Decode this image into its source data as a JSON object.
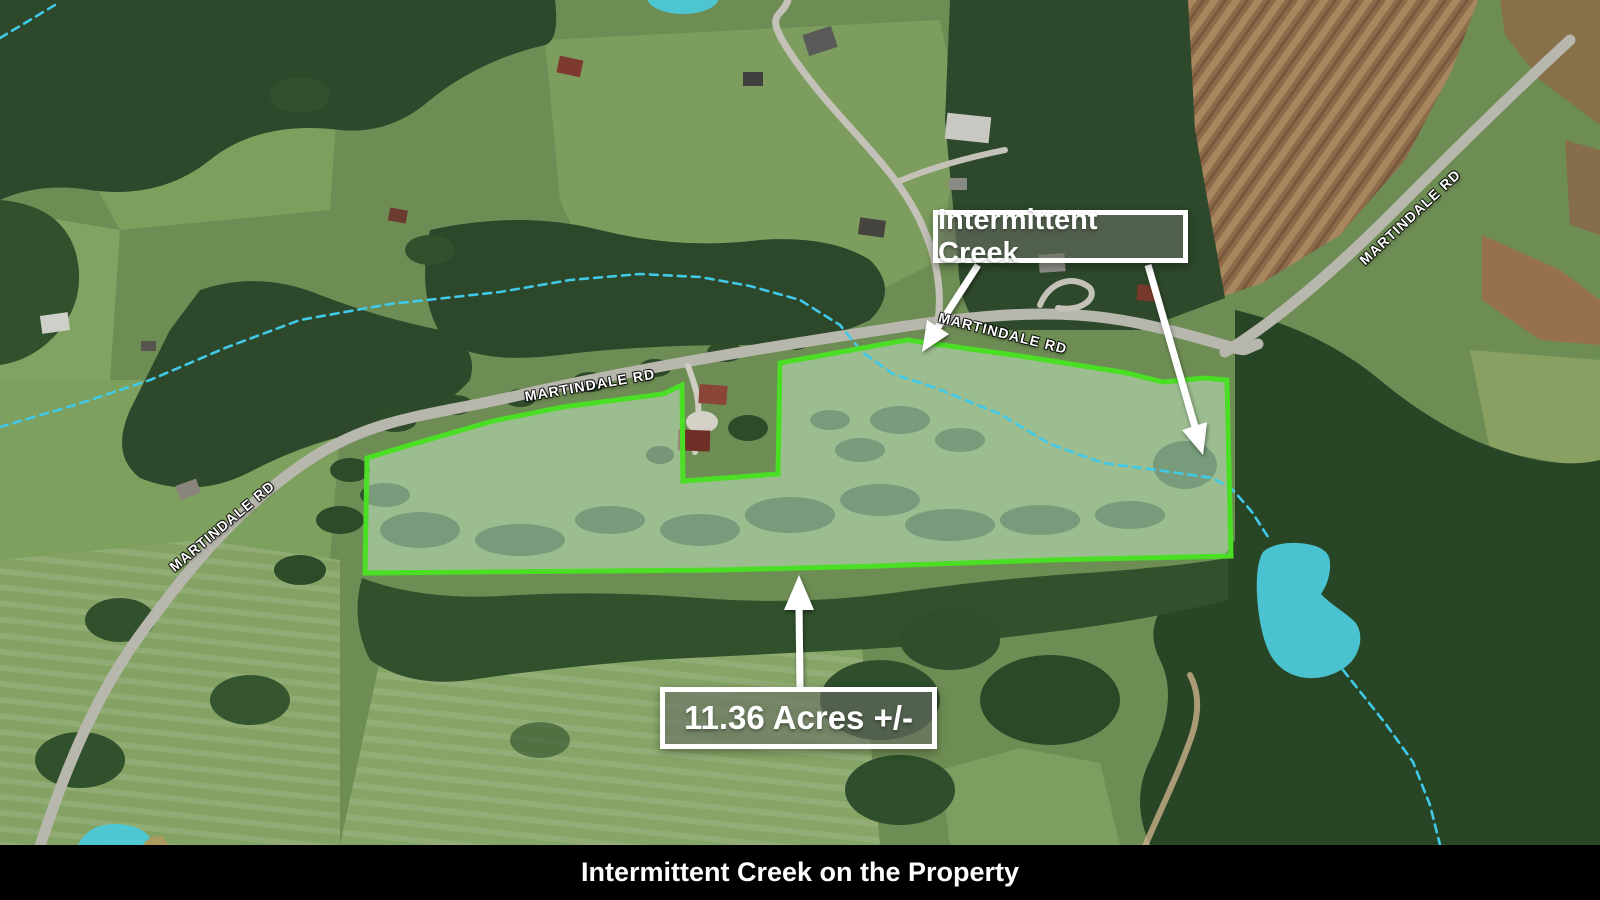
{
  "annotations": {
    "creek_label": "Intermittent Creek",
    "acreage_label": "11.36 Acres +/-"
  },
  "road_name": "MARTINDALE RD",
  "caption": "Intermittent Creek on the Property",
  "colors": {
    "boundary": "#4ade24",
    "property-fill": "rgba(219,255,228,0.42)",
    "creek": "#41c9e8",
    "pond": "#4cc9d8",
    "label-bg": "rgba(104,109,99,0.62)",
    "label-border": "#ffffff",
    "label-text": "#ffffff",
    "road-label-text": "#ffffff",
    "caption-bg": "#000000",
    "caption-text": "#ffffff",
    "arrow": "#ffffff"
  }
}
